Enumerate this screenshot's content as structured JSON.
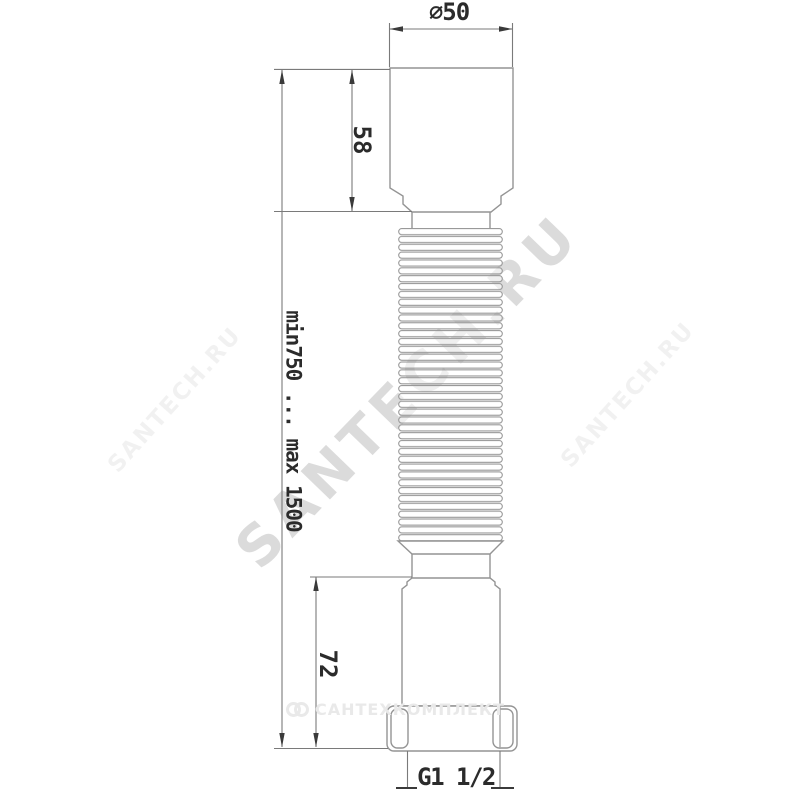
{
  "labels": {
    "top_diameter": "⌀50",
    "cuff_height": "58",
    "length_range": "min750 ... max 1500",
    "outlet_height": "72",
    "thread_size": "G1 1/2"
  },
  "watermarks": {
    "brand": "SANTECH.RU",
    "supplier": "САНТЕХКОМПЛЕКТ"
  },
  "colors": {
    "background": "#ffffff",
    "part_outline": "#949494",
    "dimension_line": "#7a7a7a",
    "arrow_and_text": "#3a3a3a",
    "label_text": "#2b2b2b",
    "watermark_big": "rgba(0,0,0,0.14)",
    "watermark_small": "rgba(0,0,0,0.055)",
    "watermark_supplier": "#e9e9e9"
  }
}
